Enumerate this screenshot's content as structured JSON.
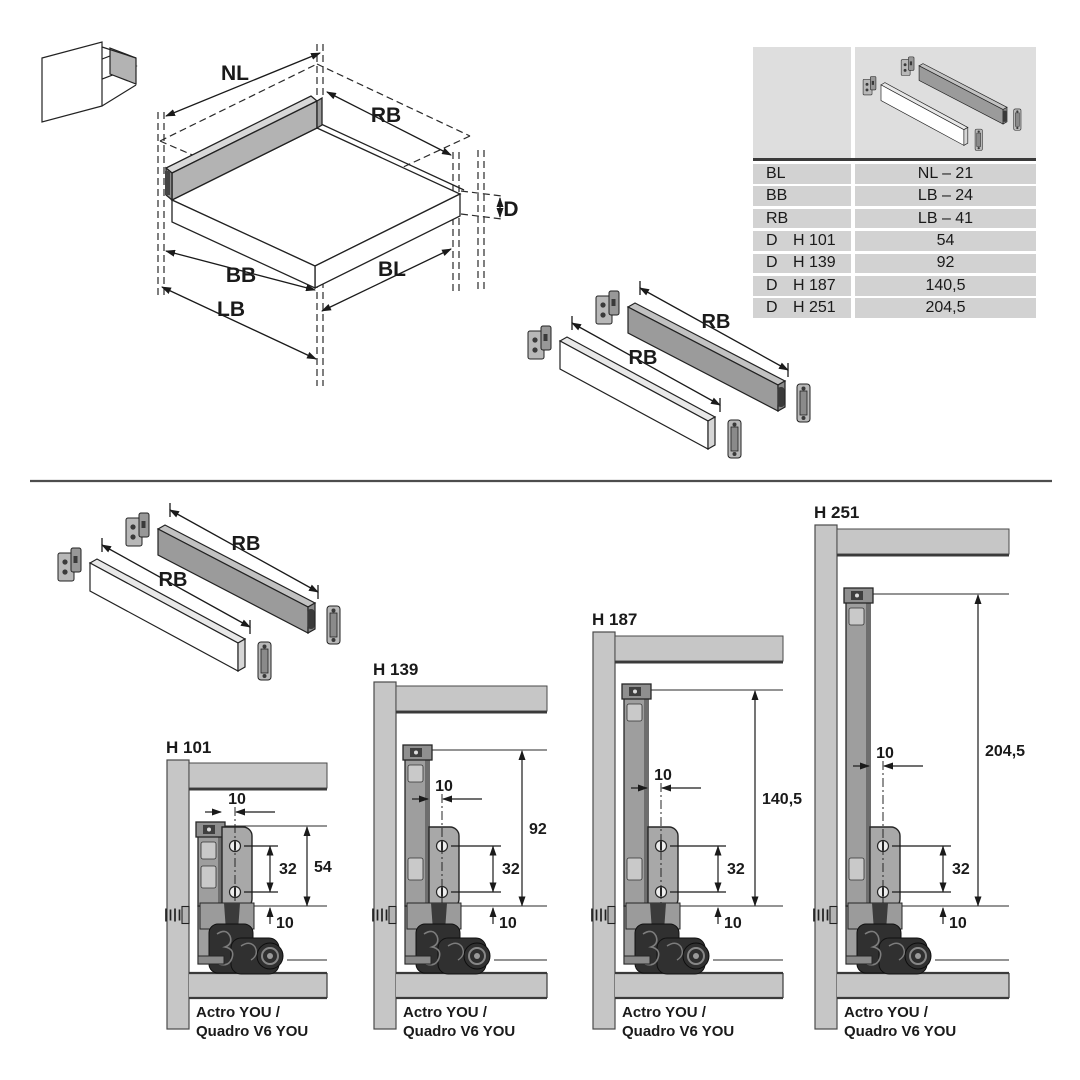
{
  "diagram": {
    "iso_labels": {
      "nl": "NL",
      "rb": "RB",
      "d": "D",
      "bb": "BB",
      "bl": "BL",
      "lb": "LB"
    },
    "rails": {
      "rb": "RB"
    },
    "table": {
      "rows": [
        {
          "param": "BL",
          "variant": "",
          "value": "NL – 21"
        },
        {
          "param": "BB",
          "variant": "",
          "value": "LB – 24"
        },
        {
          "param": "RB",
          "variant": "",
          "value": "LB – 41"
        },
        {
          "param": "D",
          "variant": "H 101",
          "value": "54"
        },
        {
          "param": "D",
          "variant": "H 139",
          "value": "92"
        },
        {
          "param": "D",
          "variant": "H 187",
          "value": "140,5"
        },
        {
          "param": "D",
          "variant": "H 251",
          "value": "204,5"
        }
      ]
    },
    "panels": [
      {
        "id": "h101",
        "title": "H 101",
        "dim_top": "10",
        "dim_holes": "32",
        "dim_total": "54",
        "dim_bottom": "10",
        "label1": "Actro YOU /",
        "label2": "Quadro V6 YOU"
      },
      {
        "id": "h139",
        "title": "H 139",
        "dim_top": "10",
        "dim_holes": "32",
        "dim_total": "92",
        "dim_bottom": "10",
        "label1": "Actro YOU /",
        "label2": "Quadro V6 YOU"
      },
      {
        "id": "h187",
        "title": "H 187",
        "dim_top": "10",
        "dim_holes": "32",
        "dim_total": "140,5",
        "dim_bottom": "10",
        "label1": "Actro YOU /",
        "label2": "Quadro V6 YOU"
      },
      {
        "id": "h251",
        "title": "H 251",
        "dim_top": "10",
        "dim_holes": "32",
        "dim_total": "204,5",
        "dim_bottom": "10",
        "label1": "Actro YOU /",
        "label2": "Quadro V6 YOU"
      }
    ],
    "colors": {
      "panel_gray": "#c6c6c6",
      "table_row": "#d2d2d2",
      "table_head": "#dedede",
      "rail_gray": "#9b9b9b",
      "wall_gray": "#b3b3b3",
      "line_dark": "#1a1a1a"
    }
  }
}
